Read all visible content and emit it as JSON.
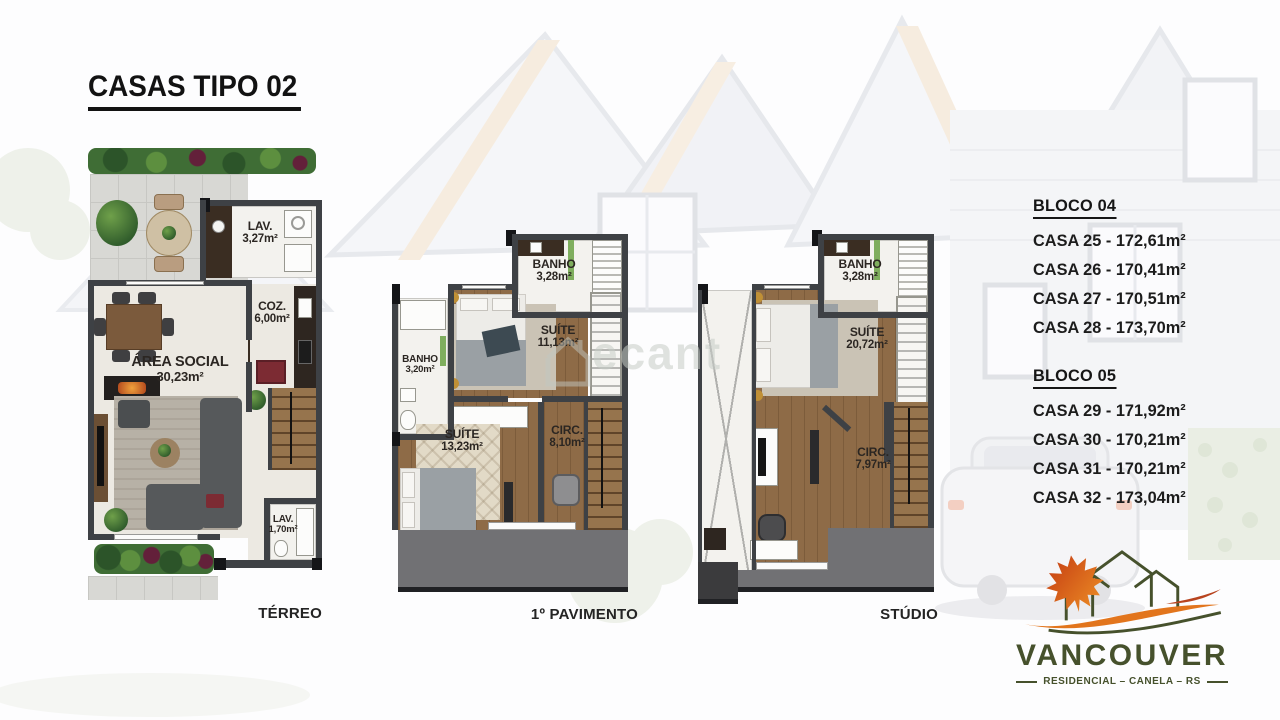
{
  "title": "CASAS TIPO 02",
  "watermark": "ecant",
  "plans": {
    "terreo": {
      "caption": "TÉRREO",
      "lav_top": {
        "name": "LAV.",
        "area": "3,27m²"
      },
      "coz": {
        "name": "COZ.",
        "area": "6,00m²"
      },
      "area_social": {
        "name": "ÁREA SOCIAL",
        "area": "30,23m²"
      },
      "lav_bottom": {
        "name": "LAV.",
        "area": "1,70m²"
      }
    },
    "pavimento": {
      "caption": "1º PAVIMENTO",
      "banho_top": {
        "name": "BANHO",
        "area": "3,28m²"
      },
      "banho_left": {
        "name": "BANHO",
        "area": "3,20m²"
      },
      "suite_top": {
        "name": "SUÍTE",
        "area": "11,13m²"
      },
      "suite_main": {
        "name": "SUÍTE",
        "area": "13,23m²"
      },
      "circ": {
        "name": "CIRC.",
        "area": "8,10m²"
      }
    },
    "studio": {
      "caption": "STÚDIO",
      "banho": {
        "name": "BANHO",
        "area": "3,28m²"
      },
      "suite": {
        "name": "SUÍTE",
        "area": "20,72m²"
      },
      "circ": {
        "name": "CIRC.",
        "area": "7,97m²"
      }
    }
  },
  "blocks": [
    {
      "heading": "BLOCO 04",
      "items": [
        "CASA 25 - 172,61m²",
        "CASA 26 - 170,41m²",
        "CASA 27 - 170,51m²",
        "CASA 28 - 173,70m²"
      ]
    },
    {
      "heading": "BLOCO 05",
      "items": [
        "CASA 29 - 171,92m²",
        "CASA 30 - 170,21m²",
        "CASA 31 - 170,21m²",
        "CASA 32 - 173,04m²"
      ]
    }
  ],
  "logo": {
    "brand": "VANCOUVER",
    "subtitle": "RESIDENCIAL – CANELA – RS"
  },
  "colors": {
    "brand_green": "#46512c",
    "leaf_red": "#c33a12",
    "leaf_orange": "#ef9226",
    "wall_gray": "#3e4145",
    "wood_floor": "#8e6b47",
    "roof_gray": "#717174"
  }
}
